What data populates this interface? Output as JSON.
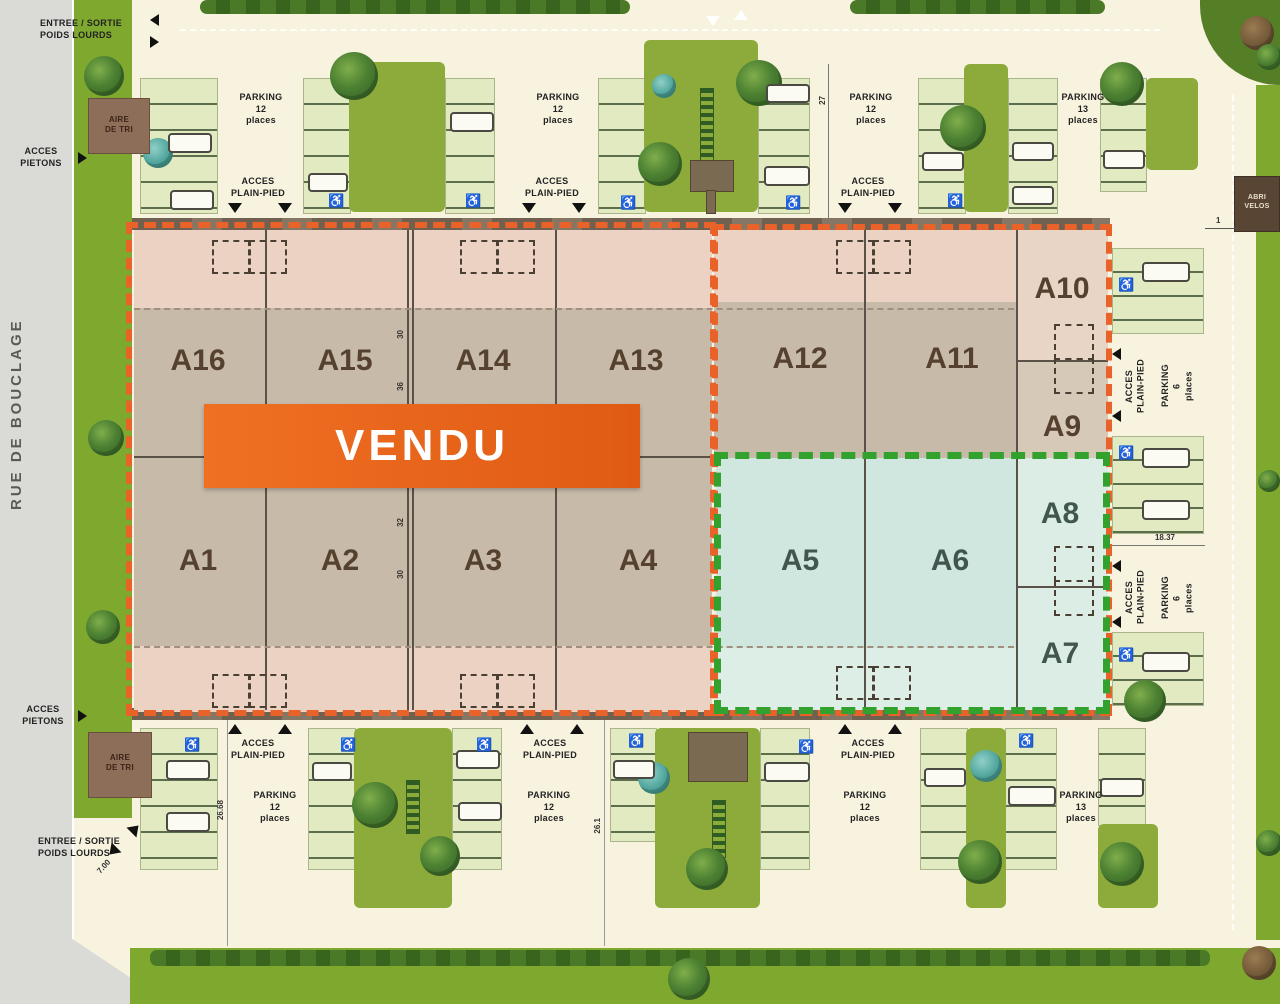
{
  "street": {
    "name": "RUE DE BOUCLAGE"
  },
  "banner": {
    "sold": "VENDU"
  },
  "units": [
    "A16",
    "A15",
    "A14",
    "A13",
    "A12",
    "A11",
    "A10",
    "A9",
    "A1",
    "A2",
    "A3",
    "A4",
    "A5",
    "A6",
    "A8",
    "A7"
  ],
  "labels": {
    "parking": "PARKING",
    "count_12": "12",
    "count_13": "13",
    "count_6": "6",
    "places": "places",
    "acces": "ACCES",
    "plain_pied": "PLAIN-PIED",
    "pietons": "PIETONS",
    "entree_sortie": "ENTREE / SORTIE",
    "poids_lourds": "POIDS LOURDS",
    "aire_line1": "AIRE",
    "aire_line2": "DE TRI",
    "abri_line1": "ABRI",
    "abri_line2": "VELOS"
  },
  "dims": {
    "top": "27",
    "gate": "1",
    "right_lane": "18.37",
    "bottom_left": "26.68",
    "bottom_center": "26.1",
    "entrance_width": "7.00",
    "walls": [
      "30",
      "36",
      "32",
      "30"
    ]
  },
  "icons": {
    "wheelchair": "♿"
  },
  "colors": {
    "accent_orange": "#e8611f",
    "dashed_green": "#33a12e",
    "building_grey": "#c7baa9",
    "building_pink": "#ecd2c3",
    "teal_section": "#cfe7df",
    "site_green": "#7fa82f"
  }
}
